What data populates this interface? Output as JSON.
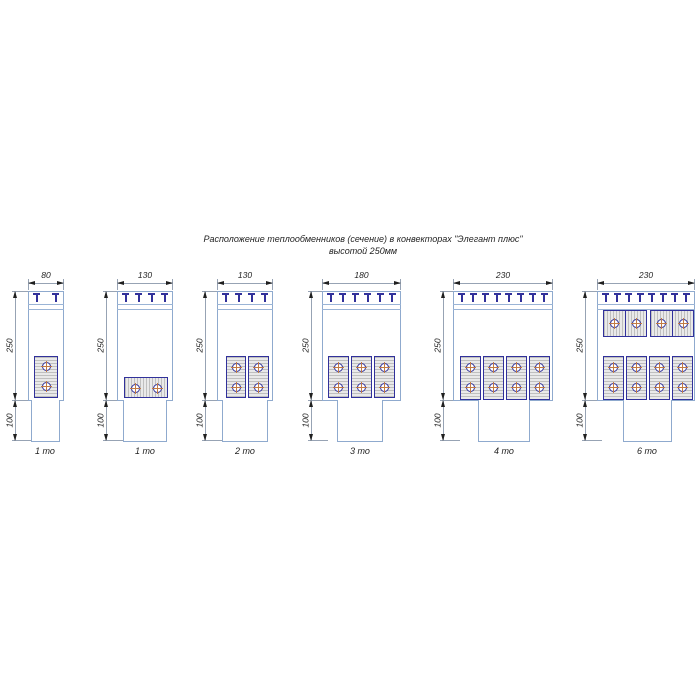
{
  "title": {
    "line1": "Расположение теплообменников (сечение) в конвекторах \"Элегант плюс\"",
    "line2": "высотой 250мм"
  },
  "vertical_dimensions": {
    "body_height": "250",
    "duct_height": "100"
  },
  "convectors": [
    {
      "width": "80",
      "label": "1 то",
      "grille_teeth": 2,
      "exchanger_blocks": 1,
      "tubes": 2
    },
    {
      "width": "130",
      "label": "1 то",
      "grille_teeth": 4,
      "exchanger_blocks": 1,
      "tubes": 2
    },
    {
      "width": "130",
      "label": "2 то",
      "grille_teeth": 4,
      "exchanger_blocks": 2,
      "tubes": 4
    },
    {
      "width": "180",
      "label": "3 то",
      "grille_teeth": 6,
      "exchanger_blocks": 3,
      "tubes": 6
    },
    {
      "width": "230",
      "label": "4 то",
      "grille_teeth": 8,
      "exchanger_blocks": 4,
      "tubes": 8
    },
    {
      "width": "230",
      "label": "6 то",
      "grille_teeth": 8,
      "exchanger_blocks": 6,
      "tubes": 12
    }
  ],
  "colors": {
    "outline": "#8FAACE",
    "grille_band": "#9AB4D6",
    "exchanger_border": "#31319B",
    "hatch_fill": "#E9E9E9",
    "hatch_line": "#BFBFBF",
    "tube_centerline": "#C27B45",
    "dimension_line": "#97A3B4",
    "text": "#1F1F1F"
  }
}
